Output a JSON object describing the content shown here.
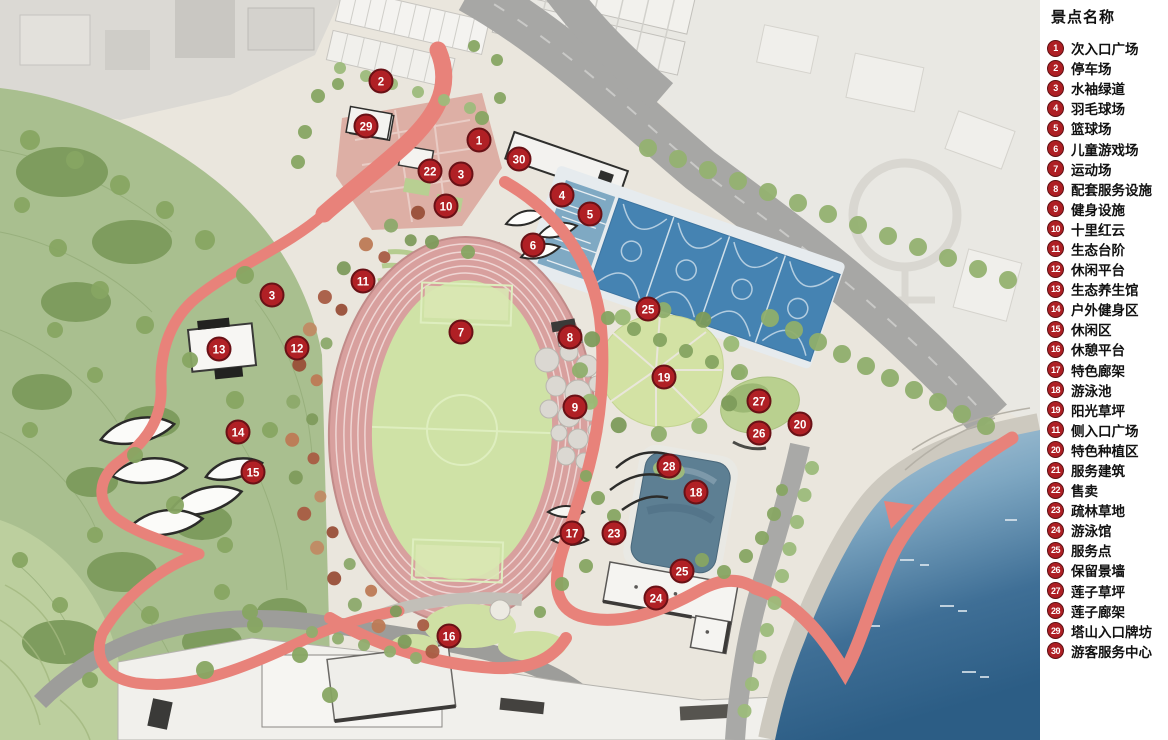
{
  "legend": {
    "title": "景点名称",
    "items": [
      {
        "num": "1",
        "label": "次入口广场"
      },
      {
        "num": "2",
        "label": "停车场"
      },
      {
        "num": "3",
        "label": "水袖绿道"
      },
      {
        "num": "4",
        "label": "羽毛球场"
      },
      {
        "num": "5",
        "label": "篮球场"
      },
      {
        "num": "6",
        "label": "儿童游戏场"
      },
      {
        "num": "7",
        "label": "运动场"
      },
      {
        "num": "8",
        "label": "配套服务设施"
      },
      {
        "num": "9",
        "label": "健身设施"
      },
      {
        "num": "10",
        "label": "十里红云"
      },
      {
        "num": "11",
        "label": "生态台阶"
      },
      {
        "num": "12",
        "label": "休闲平台"
      },
      {
        "num": "13",
        "label": "生态养生馆"
      },
      {
        "num": "14",
        "label": "户外健身区"
      },
      {
        "num": "15",
        "label": "休闲区"
      },
      {
        "num": "16",
        "label": "休憩平台"
      },
      {
        "num": "17",
        "label": "特色廊架"
      },
      {
        "num": "18",
        "label": "游泳池"
      },
      {
        "num": "19",
        "label": "阳光草坪"
      },
      {
        "num": "11",
        "label": "侧入口广场"
      },
      {
        "num": "20",
        "label": "特色种植区"
      },
      {
        "num": "21",
        "label": "服务建筑"
      },
      {
        "num": "22",
        "label": "售卖"
      },
      {
        "num": "23",
        "label": "疏林草地"
      },
      {
        "num": "24",
        "label": "游泳馆"
      },
      {
        "num": "25",
        "label": "服务点"
      },
      {
        "num": "26",
        "label": "保留景墙"
      },
      {
        "num": "27",
        "label": "莲子草坪"
      },
      {
        "num": "28",
        "label": "莲子廊架"
      },
      {
        "num": "29",
        "label": "塔山入口牌坊"
      },
      {
        "num": "30",
        "label": "游客服务中心"
      }
    ]
  },
  "map": {
    "markers": [
      {
        "num": "2",
        "x": 381,
        "y": 81
      },
      {
        "num": "29",
        "x": 366,
        "y": 126
      },
      {
        "num": "1",
        "x": 479,
        "y": 140
      },
      {
        "num": "30",
        "x": 519,
        "y": 159
      },
      {
        "num": "22",
        "x": 430,
        "y": 171
      },
      {
        "num": "3",
        "x": 461,
        "y": 174
      },
      {
        "num": "4",
        "x": 562,
        "y": 195
      },
      {
        "num": "10",
        "x": 446,
        "y": 206
      },
      {
        "num": "5",
        "x": 590,
        "y": 214
      },
      {
        "num": "6",
        "x": 533,
        "y": 245
      },
      {
        "num": "11",
        "x": 363,
        "y": 281
      },
      {
        "num": "3",
        "x": 272,
        "y": 295
      },
      {
        "num": "25",
        "x": 648,
        "y": 309
      },
      {
        "num": "7",
        "x": 461,
        "y": 332
      },
      {
        "num": "8",
        "x": 570,
        "y": 337
      },
      {
        "num": "12",
        "x": 297,
        "y": 348
      },
      {
        "num": "13",
        "x": 219,
        "y": 349
      },
      {
        "num": "19",
        "x": 664,
        "y": 377
      },
      {
        "num": "27",
        "x": 759,
        "y": 401
      },
      {
        "num": "9",
        "x": 575,
        "y": 407
      },
      {
        "num": "20",
        "x": 800,
        "y": 424
      },
      {
        "num": "14",
        "x": 238,
        "y": 432
      },
      {
        "num": "26",
        "x": 759,
        "y": 433
      },
      {
        "num": "28",
        "x": 669,
        "y": 466
      },
      {
        "num": "15",
        "x": 253,
        "y": 472
      },
      {
        "num": "18",
        "x": 696,
        "y": 492
      },
      {
        "num": "17",
        "x": 572,
        "y": 533
      },
      {
        "num": "23",
        "x": 614,
        "y": 533
      },
      {
        "num": "25",
        "x": 682,
        "y": 571
      },
      {
        "num": "24",
        "x": 656,
        "y": 598
      },
      {
        "num": "16",
        "x": 449,
        "y": 636
      }
    ]
  },
  "colors": {
    "marker_red": "#b02025",
    "marker_ring": "#691116",
    "legend_badge": "#ae1f24",
    "track_pink": "#d8a09e",
    "field_green": "#cfe2a6",
    "court_blue": "#4583b2",
    "badminton_blue": "#7fa9c3",
    "pool_slate": "#5d7f93",
    "greenway_red": "#e8827a",
    "water_deep": "#2c5d85",
    "water_light": "#b9d0de",
    "hill_green": "#a9bf8f",
    "road_gray": "#a7a7a5",
    "base_beige": "#eae6dd"
  }
}
